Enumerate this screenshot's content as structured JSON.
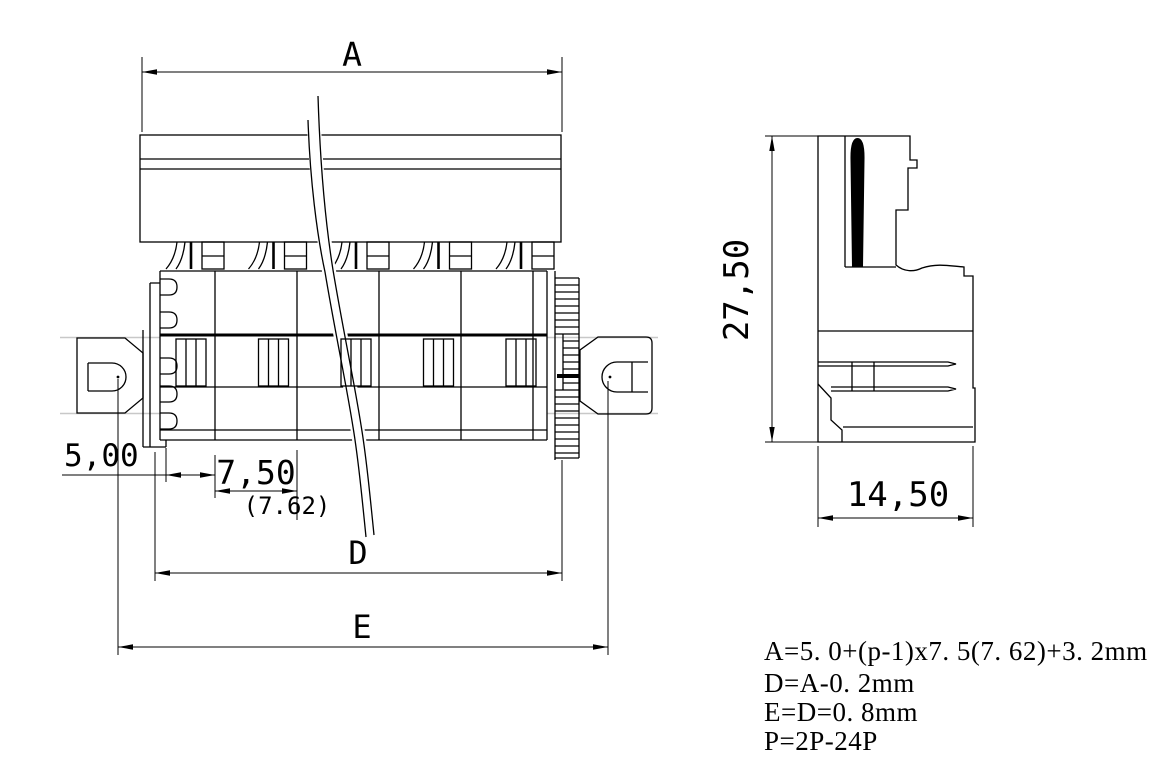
{
  "colors": {
    "background": "#ffffff",
    "line": "#000000",
    "accent_gray": "#c8c8c8"
  },
  "front_view": {
    "dim_total_width_label": "A",
    "dim_left_offset_label": "5,00",
    "dim_pitch_label": "7,50",
    "dim_pitch_alt_label": "(7.62)",
    "dim_d_label": "D",
    "dim_e_label": "E"
  },
  "side_view": {
    "dim_height_label": "27,50",
    "dim_depth_label": "14,50"
  },
  "notes": {
    "line1": "A=5. 0+(p-1)x7. 5(7. 62)+3. 2mm",
    "line2": "D=A-0. 2mm",
    "line3": "E=D=0. 8mm",
    "line4": "P=2P-24P"
  }
}
